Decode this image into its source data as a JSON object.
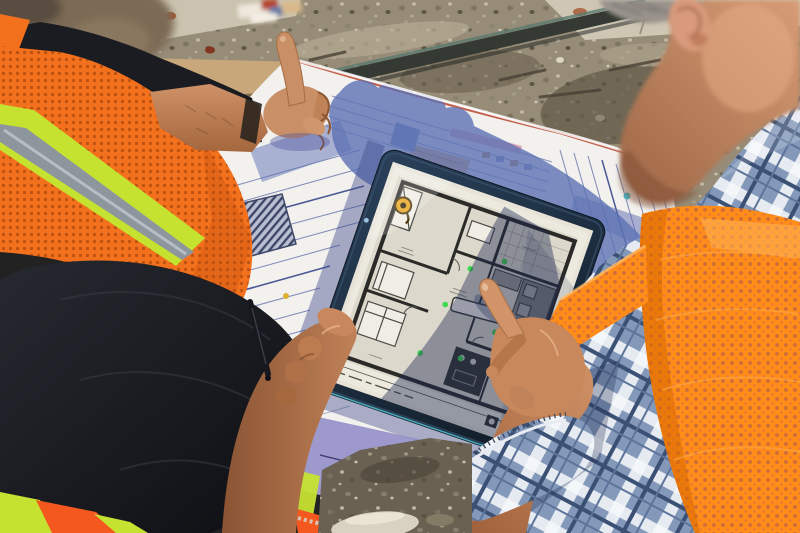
{
  "meta": {
    "domain": "photograph",
    "description": "Two construction workers in hi-vis safety vests review an architectural floor plan on a tablet lying over rolled-out paper blueprints at a sunny construction site; the left worker raises an index finger while the right worker touches the tablet screen."
  },
  "scene": {
    "ground": {
      "surface": "gravel and dirt construction ground",
      "concrete_slab": "pale concrete along the top edge",
      "rail": "dark metal/glass edge crossing the upper area diagonally",
      "board": "tan wooden board behind the pointing arm"
    },
    "workers": {
      "left": {
        "position": "left edge, partly out of frame",
        "shirt": "black long-sleeve shirt",
        "vest": "orange mesh hi-vis vest with yellow-green stripes and gray reflective tape",
        "gesture": "right index finger raised upward; left hand bracing the tablet corner while holding a dark pen"
      },
      "right": {
        "position": "right edge, seen from behind",
        "shirt": "blue and white plaid shirt with rolled cuff",
        "vest": "bright orange mesh hi-vis vest",
        "gesture": "index finger touching the tablet screen"
      }
    },
    "tablet": {
      "device": "dark-framed tablet computer lying on the blueprints",
      "screen_content": "black-and-white architectural floor plan with furniture symbols",
      "pin_marker": "yellow-orange circular marker in the upper-left room",
      "led_dots": "six small green dots scattered on the plan",
      "shadow": "right half of the screen lies in cast shadow",
      "camera": "small camera dot on the left bezel"
    },
    "blueprint": {
      "type": "large white paper construction drawing sheet",
      "details": "fine blue line work, dark hatched block, pink / orange / blue highlighted details, red edge line",
      "shadow": "strong blue shadow of the pointing hand cast across the sheet; purple shadow band near the bottom edge"
    }
  },
  "palette": {
    "gravel": "#968c77",
    "gravel_dark": "#5f5747",
    "concrete": "#cfc7b4",
    "rail_dark": "#343a33",
    "board_tan": "#c8a77b",
    "paper": "#f2f1ee",
    "blueprint_line": "#7d88b8",
    "blueprint_dark": "#4b5896",
    "shadow_blue": "#5d72b4",
    "paper_shadow_purple": "#958fc8",
    "tablet_frame_dark": "#13202e",
    "screen_bg": "#e7e3d7",
    "plan_wall": "#2a2a28",
    "pin_yellow": "#e9a61a",
    "led_green": "#3fd84f",
    "vest_orange_left": "#f3701d",
    "vest_orange_right": "#ff8d17",
    "vest_lime": "#c6e231",
    "reflective_gray": "#8e969d",
    "shirt_black": "#1a1c21",
    "skin": "#c9885f",
    "skin_shadow": "#9a6242",
    "hair_gray": "#99938c",
    "plaid_blue": "#8499ba",
    "plaid_white": "#e6ebf2",
    "plaid_navy": "#3a5074",
    "stone_light": "#d9d2c2",
    "cyan_edge": "#57c8d8"
  }
}
